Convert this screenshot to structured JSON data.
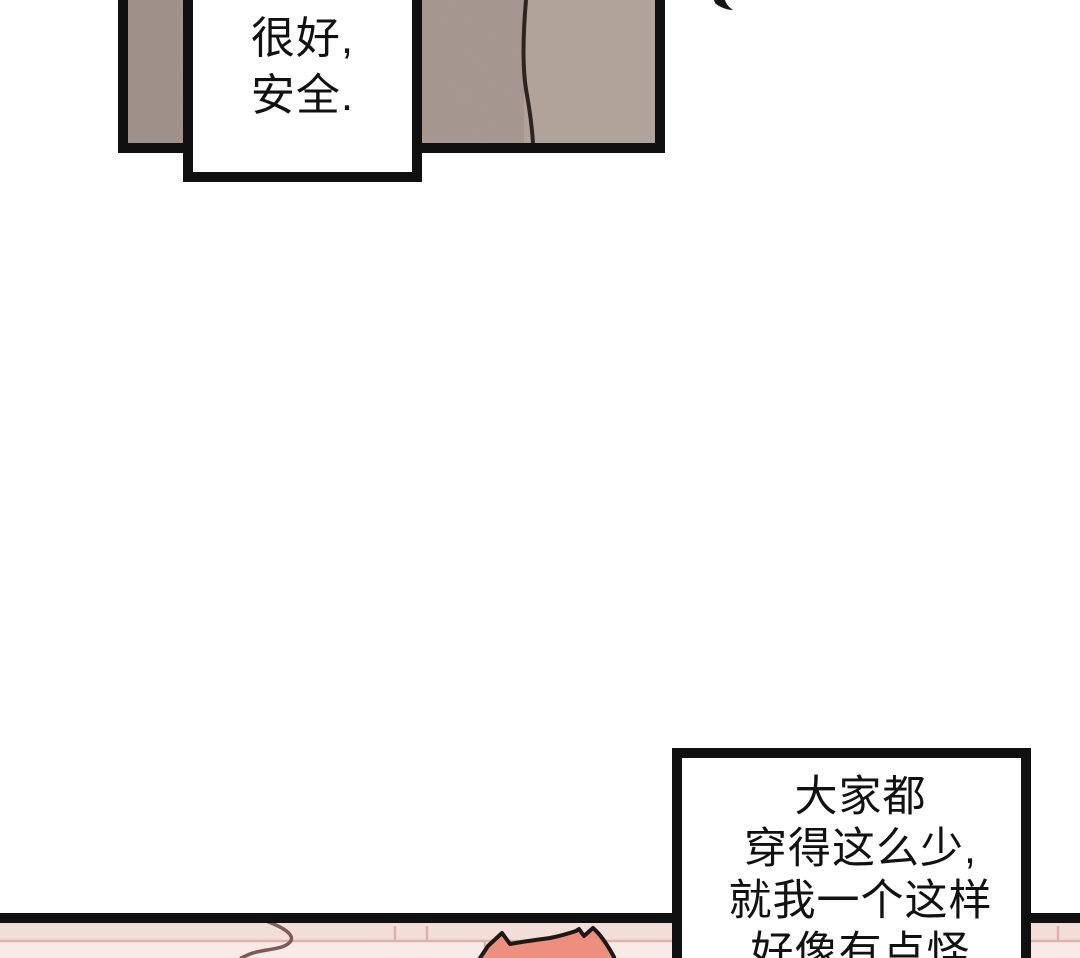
{
  "page": {
    "kind": "webtoon-comic-page",
    "background": "#ffffff",
    "width_px": 1080,
    "height_px": 958
  },
  "top_panel": {
    "description": "wall interior, panel cropped at top of image",
    "border_color": "#101010",
    "wall_left_color": "#9e8f89",
    "wall_mid_color": "#a6968f",
    "wall_right_color": "#b2a39a",
    "seam_color": "#2e251f"
  },
  "speech_bubble_top": {
    "lines": [
      "很好,",
      "安全."
    ]
  },
  "marks": {
    "ink_mark_color": "#141414"
  },
  "bottom_panel": {
    "description": "pink brick wall, panel cropped at bottom of image",
    "border_color": "#101010",
    "brick_base_color": "#f8ebe7",
    "brick_band_color": "#f3ddd8",
    "mortar_color": "#dcb3ab",
    "curve_mark_color": "#7d5b55"
  },
  "character": {
    "hair_color": "#ee8e7e",
    "outline_color": "#1a1a1a"
  },
  "speech_bubble_bottom": {
    "lines": [
      "大家都",
      "穿得这么少,",
      "就我一个这样",
      "好像有点怪"
    ]
  }
}
